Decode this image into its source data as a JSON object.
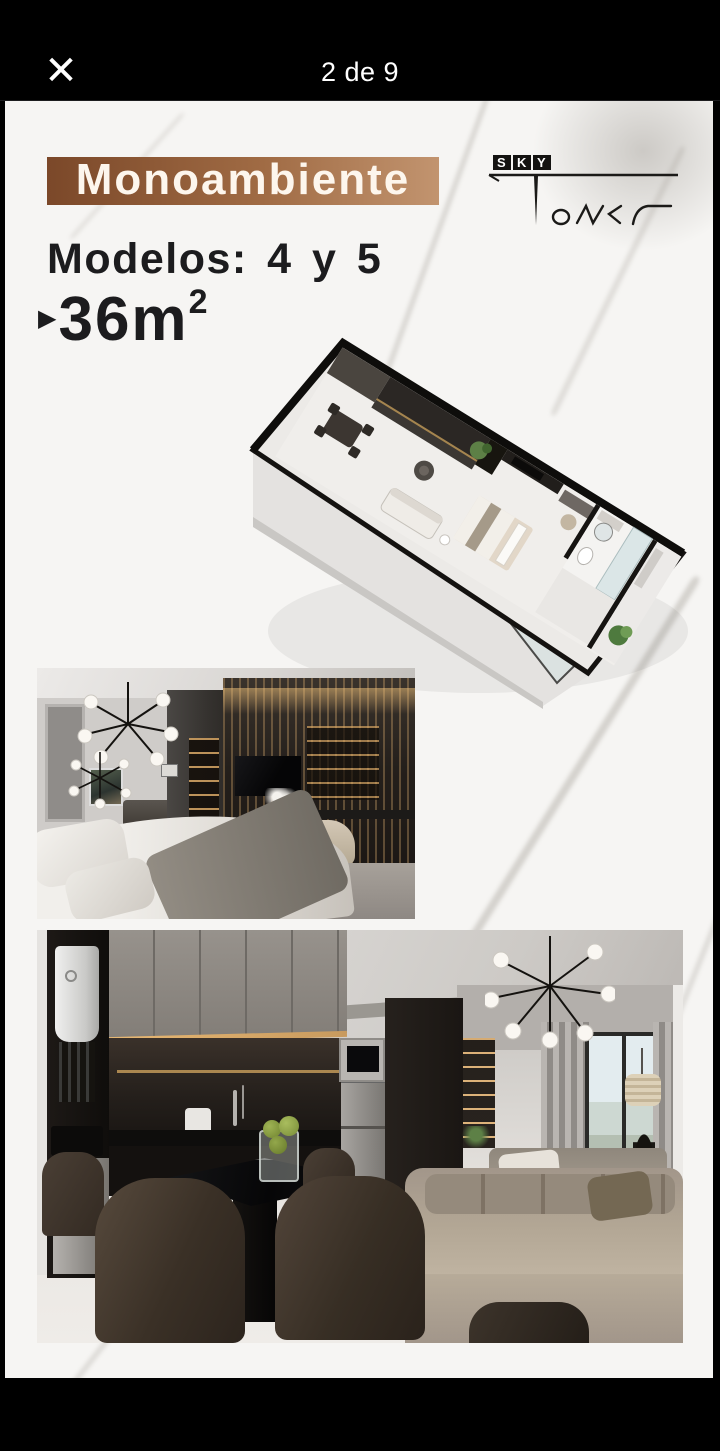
{
  "viewer": {
    "close_label": "✕",
    "counter": "2 de 9"
  },
  "flyer": {
    "banner_title": "Monoambiente",
    "models_label": "Modelos: 4 y 5",
    "area": {
      "bullet": "▶",
      "value": "36m",
      "exponent": "2"
    },
    "logo": {
      "letters": [
        "S",
        "K",
        "Y"
      ],
      "script": "ower"
    }
  },
  "colors": {
    "topbar_bg": "#000000",
    "marble_base": "#f6f5f3",
    "banner_left": "#7b4829",
    "banner_right": "#c2946f",
    "banner_text": "#fdf6ed",
    "text_dark": "#1c1c1e",
    "logo_ink": "#1b1a18"
  }
}
